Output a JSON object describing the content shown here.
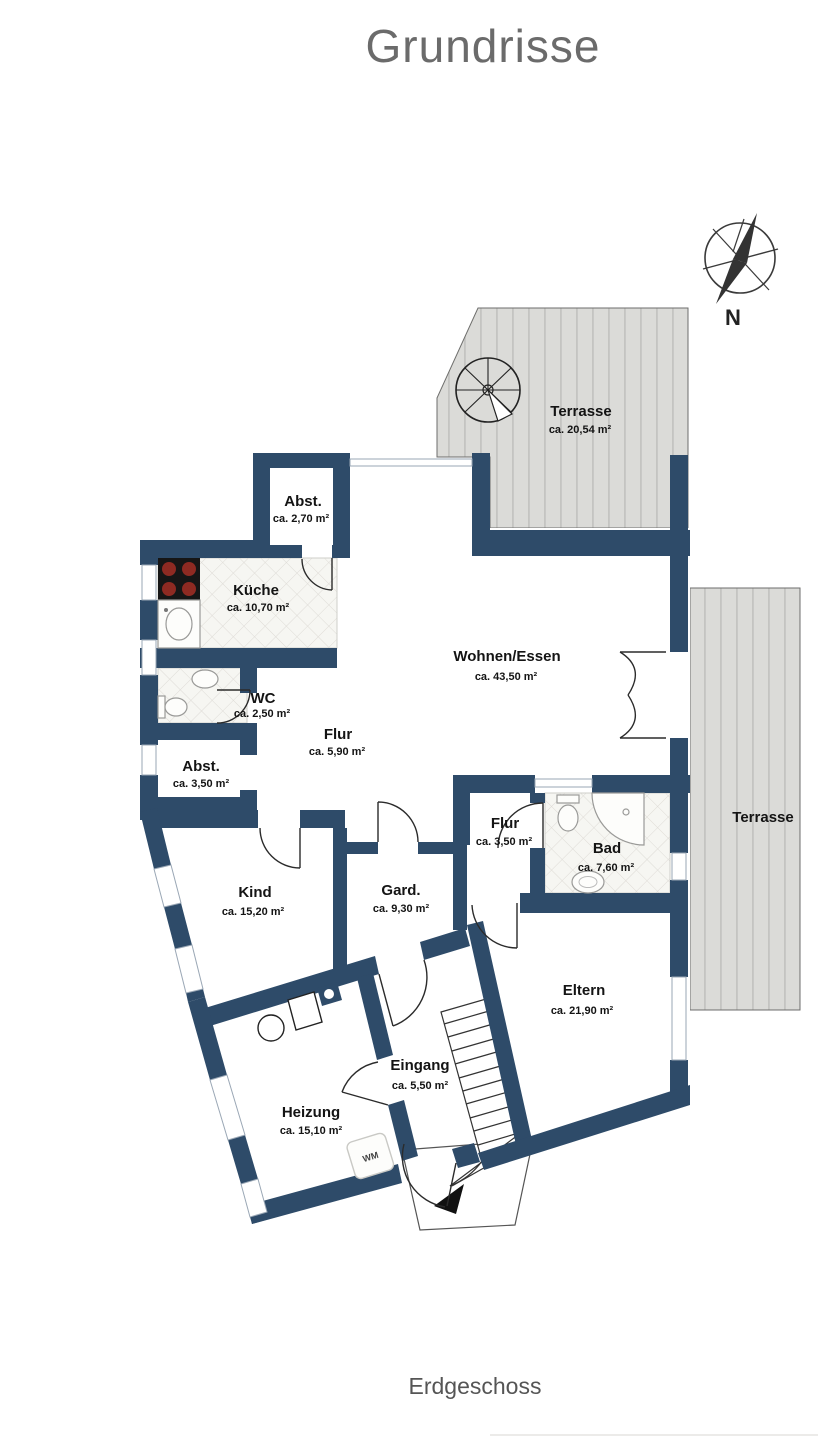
{
  "title": "Grundrisse",
  "floor_label": "Erdgeschoss",
  "compass": {
    "label": "N"
  },
  "colors": {
    "wall": "#2e4b69",
    "terrace_fill": "#dbdbd8",
    "terrace_stripe": "#c4c4c1",
    "tile_fill": "#f6f6f2",
    "title_text": "#6b6b6b",
    "label_text": "#141414"
  },
  "rooms": [
    {
      "id": "terrasse-top",
      "name": "Terrasse",
      "area": "ca. 20,54 m²"
    },
    {
      "id": "abst-klein",
      "name": "Abst.",
      "area": "ca. 2,70 m²"
    },
    {
      "id": "kueche",
      "name": "Küche",
      "area": "ca. 10,70 m²"
    },
    {
      "id": "wc",
      "name": "WC",
      "area": "ca. 2,50 m²"
    },
    {
      "id": "flur",
      "name": "Flur",
      "area": "ca. 5,90 m²"
    },
    {
      "id": "abst-gross",
      "name": "Abst.",
      "area": "ca. 3,50 m²"
    },
    {
      "id": "wohnen-essen",
      "name": "Wohnen/Essen",
      "area": "ca. 43,50 m²"
    },
    {
      "id": "terrasse-seite",
      "name": "Terrasse",
      "area": ""
    },
    {
      "id": "flur-2",
      "name": "Flur",
      "area": "ca. 3,50 m²"
    },
    {
      "id": "bad",
      "name": "Bad",
      "area": "ca. 7,60 m²"
    },
    {
      "id": "kind",
      "name": "Kind",
      "area": "ca. 15,20 m²"
    },
    {
      "id": "gard",
      "name": "Gard.",
      "area": "ca. 9,30 m²"
    },
    {
      "id": "eltern",
      "name": "Eltern",
      "area": "ca. 21,90 m²"
    },
    {
      "id": "eingang",
      "name": "Eingang",
      "area": "ca. 5,50 m²"
    },
    {
      "id": "heizung",
      "name": "Heizung",
      "area": "ca. 15,10 m²"
    }
  ],
  "appliances": {
    "washer_label": "WM"
  }
}
